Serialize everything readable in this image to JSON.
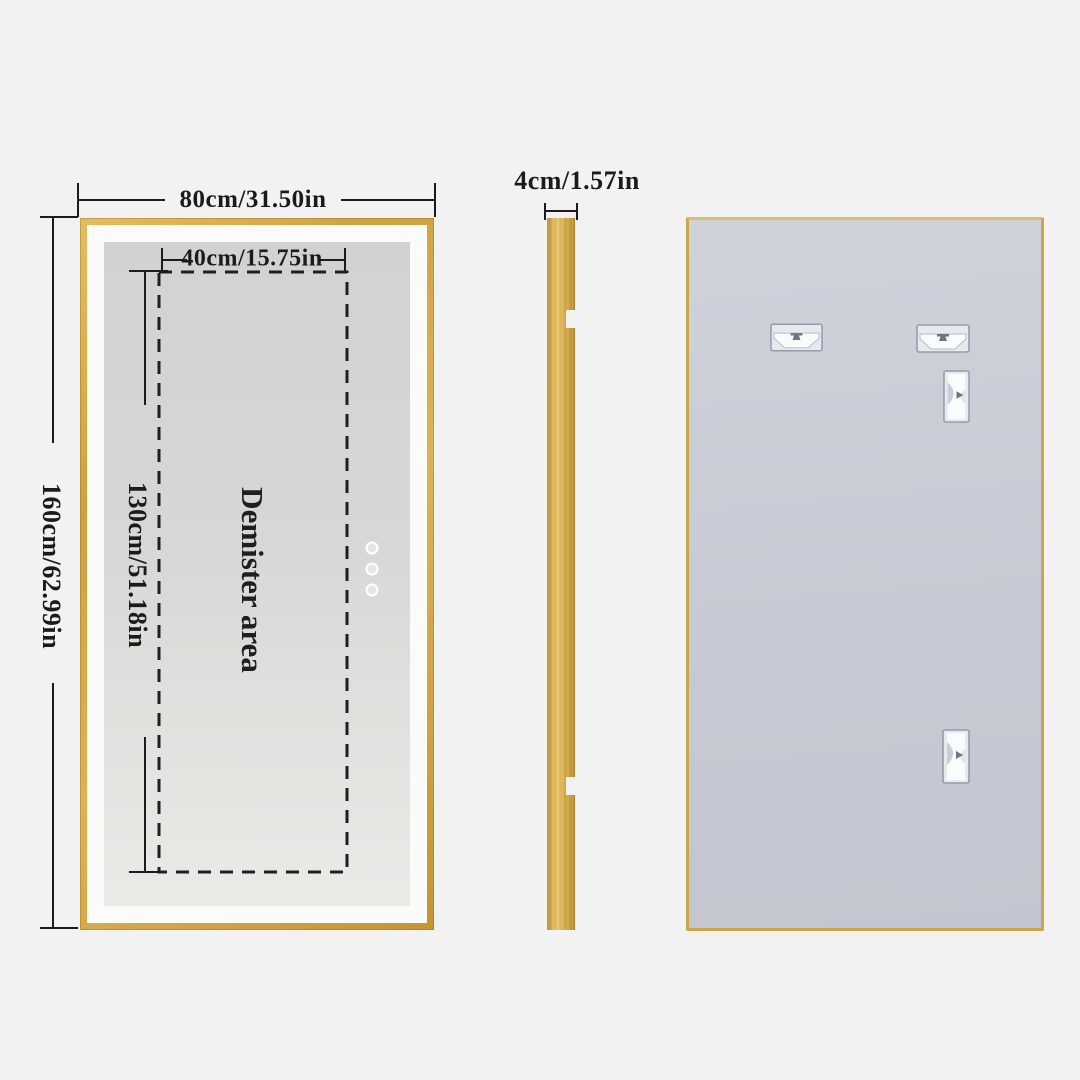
{
  "page": {
    "background_color": "#f2f2f2",
    "line_color": "#1c1c1c",
    "frame_gold_color": "#cfa544",
    "back_panel_color": "#c8ccd6"
  },
  "front_view": {
    "overall_width_label": "80cm/31.50in",
    "overall_height_label": "160cm/62.99in",
    "demister": {
      "area_label": "Demister area",
      "width_label": "40cm/15.75in",
      "height_label": "130cm/51.18in"
    },
    "touch_button_count": "3"
  },
  "side_view": {
    "thickness_label": "4cm/1.57in"
  }
}
